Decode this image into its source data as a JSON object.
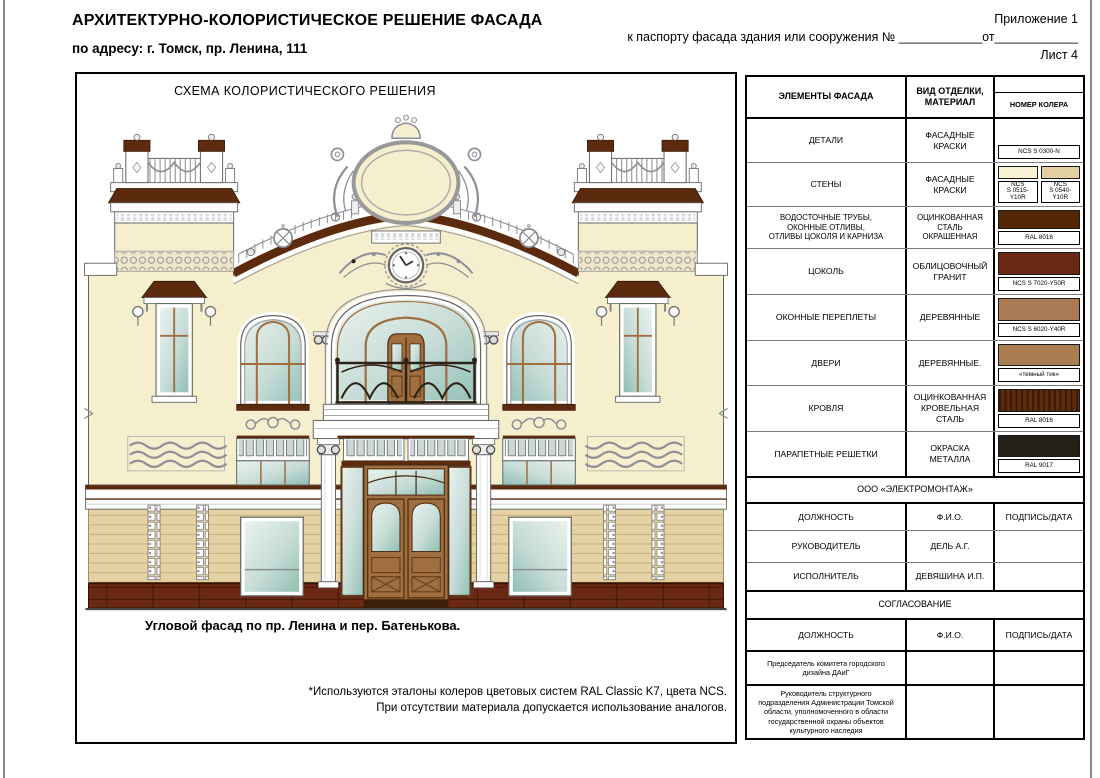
{
  "page": {
    "title": "АРХИТЕКТУРНО-КОЛОРИСТИЧЕСКОЕ РЕШЕНИЕ ФАСАДА",
    "address": "по адресу: г. Томск, пр. Ленина, 111",
    "appendix": "Приложение 1",
    "passport_line": "к паспорту фасада здания или сооружения № ____________от____________",
    "sheet_number": "Лист 4"
  },
  "drawing": {
    "title": "СХЕМА КОЛОРИСТИЧЕСКОГО РЕШЕНИЯ",
    "caption": "Угловой фасад по пр. Ленина и пер. Батенькова.",
    "footnote_line1": "*Используются эталоны колеров цветовых систем RAL Classic K7, цвета NCS.",
    "footnote_line2": "При отсутствии материала допускается использование аналогов."
  },
  "palette": {
    "cream": "#F6EFCE",
    "tan": "#E5D2A4",
    "brown": "#5C2B0E",
    "granite": "#6B2914",
    "wood": "#A06E3F",
    "iron": "#2E2216",
    "ornament": "#8F8F99"
  },
  "table": {
    "headers": {
      "col1": "ЭЛЕМЕНТЫ ФАСАДА",
      "col2": "ВИД ОТДЕЛКИ,\nМАТЕРИАЛ",
      "col3": "НОМЕР КОЛЕРА"
    },
    "color_rows": [
      {
        "element": "ДЕТАЛИ",
        "finish": "ФАСАДНЫЕ КРАСКИ",
        "swatches": [
          {
            "color": "#FFFFFF",
            "label": "NCS S 0300-N"
          }
        ]
      },
      {
        "element": "СТЕНЫ",
        "finish": "ФАСАДНЫЕ КРАСКИ",
        "swatches": [
          {
            "color": "#F8F1D2",
            "label": "NCS\nS 0515-Y10R"
          },
          {
            "color": "#E3CEA2",
            "label": "NCS\nS 0540-Y10R"
          }
        ]
      },
      {
        "element": "ВОДОСТОЧНЫЕ ТРУБЫ,\nОКОННЫЕ ОТЛИВЫ,\nОТЛИВЫ ЦОКОЛЯ И КАРНИЗА",
        "finish": "ОЦИНКОВАННАЯ\nСТАЛЬ\nОКРАШЕННАЯ",
        "swatches": [
          {
            "color": "#532606",
            "label": "RAL 8016"
          }
        ]
      },
      {
        "element": "ЦОКОЛЬ",
        "finish": "ОБЛИЦОВОЧНЫЙ\nГРАНИТ",
        "swatches": [
          {
            "color": "#6B2914",
            "label": "NCS S 7020-Y50R"
          }
        ]
      },
      {
        "element": "ОКОННЫЕ ПЕРЕПЛЕТЫ",
        "finish": "ДЕРЕВЯННЫЕ",
        "swatches": [
          {
            "color": "#A97A54",
            "label": "NCS S 6020-Y40R"
          }
        ]
      },
      {
        "element": "ДВЕРИ",
        "finish": "ДЕРЕВЯННЫЕ.",
        "swatches": [
          {
            "color": "#AB7E52",
            "label": "«темный тик»"
          }
        ]
      },
      {
        "element": "КРОВЛЯ",
        "finish": "ОЦИНКОВАННАЯ\nКРОВЕЛЬНАЯ СТАЛЬ",
        "swatches": [
          {
            "color": "#5C2C0C",
            "label": "RAL 8016"
          }
        ]
      },
      {
        "element": "ПАРАПЕТНЫЕ РЕШЕТКИ",
        "finish": "ОКРАСКА МЕТАЛЛА",
        "swatches": [
          {
            "color": "#242019",
            "label": "RAL 9017"
          }
        ]
      }
    ],
    "org_row": "ООО «ЭЛЕКТРОМОНТАЖ»",
    "staff_header": {
      "col1": "ДОЛЖНОСТЬ",
      "col2": "Ф.И.О.",
      "col3": "ПОДПИСЬ/ДАТА"
    },
    "staff_rows": [
      {
        "position": "РУКОВОДИТЕЛЬ",
        "name": "ДЕЛЬ А.Г.",
        "sign": ""
      },
      {
        "position": "ИСПОЛНИТЕЛЬ",
        "name": "ДЕВЯШИНА И.П.",
        "sign": ""
      }
    ],
    "approval_row": "СОГЛАСОВАНИЕ",
    "approval_header": {
      "col1": "ДОЛЖНОСТЬ",
      "col2": "Ф.И.О.",
      "col3": "ПОДПИСЬ/ДАТА"
    },
    "approval_rows": [
      {
        "position": "Председатель комитета городского дизайна ДАиГ",
        "name": "",
        "sign": ""
      },
      {
        "position": "Руководитель структурного подразделения Администрации Томской области, уполномоченного в области государственной охраны объектов культурного наследия",
        "name": "",
        "sign": ""
      }
    ]
  }
}
